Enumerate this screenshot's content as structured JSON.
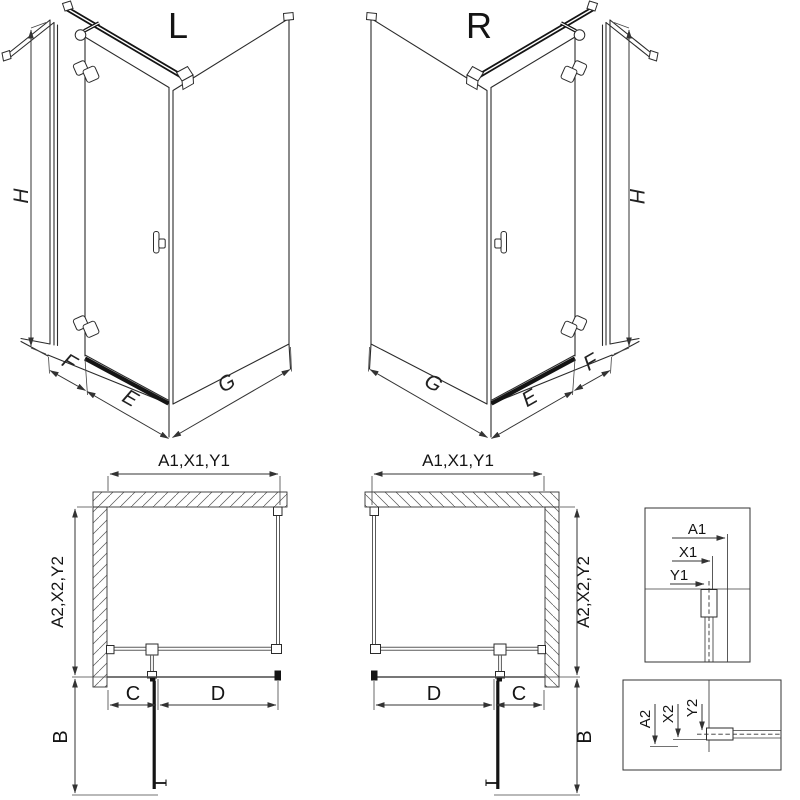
{
  "diagram": {
    "iso_left": {
      "label": "L",
      "dim_height": "H",
      "dim_f": "F",
      "dim_e": "E",
      "dim_g": "G"
    },
    "iso_right": {
      "label": "R",
      "dim_height": "H",
      "dim_f": "F",
      "dim_e": "E",
      "dim_g": "G"
    },
    "plan_left": {
      "dim_top": "A1,X1,Y1",
      "dim_side": "A2,X2,Y2",
      "dim_c": "C",
      "dim_d": "D",
      "dim_b": "B"
    },
    "plan_right": {
      "dim_top": "A1,X1,Y1",
      "dim_side": "A2,X2,Y2",
      "dim_c": "C",
      "dim_d": "D",
      "dim_b": "B"
    },
    "detail_top": {
      "dim_a1": "A1",
      "dim_x1": "X1",
      "dim_y1": "Y1"
    },
    "detail_bottom": {
      "dim_a2": "A2",
      "dim_x2": "X2",
      "dim_y2": "Y2"
    },
    "colors": {
      "line": "#2b2b2b",
      "dark": "#141414",
      "background": "#ffffff"
    }
  }
}
